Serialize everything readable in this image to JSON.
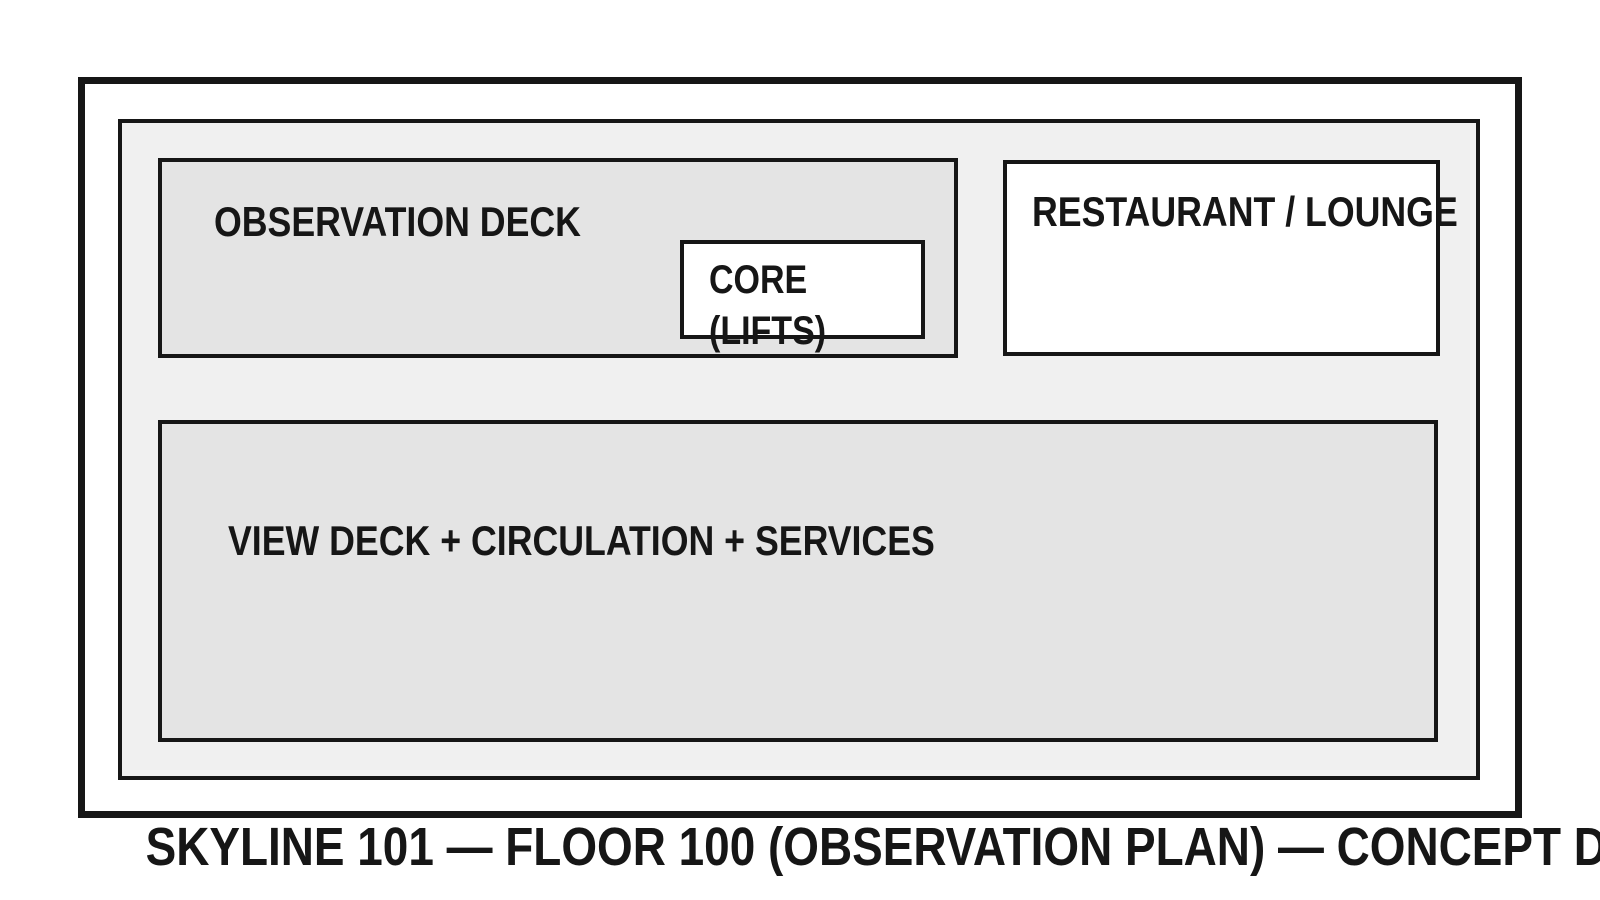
{
  "drawing": {
    "caption": "SKYLINE 101 — FLOOR 100 (OBSERVATION PLAN) — CONCEPT DRAWING",
    "zones": {
      "observation_deck": {
        "label": "OBSERVATION DECK"
      },
      "core": {
        "line1": "CORE",
        "line2": "(LIFTS)"
      },
      "restaurant": {
        "label": "RESTAURANT / LOUNGE"
      },
      "view_deck": {
        "label": "VIEW DECK + CIRCULATION + SERVICES"
      }
    },
    "colors": {
      "background": "#ffffff",
      "line": "#161616",
      "floor_plate_fill": "#f0f0f0",
      "deck_fill": "#e4e4e4",
      "room_fill": "#ffffff"
    }
  }
}
